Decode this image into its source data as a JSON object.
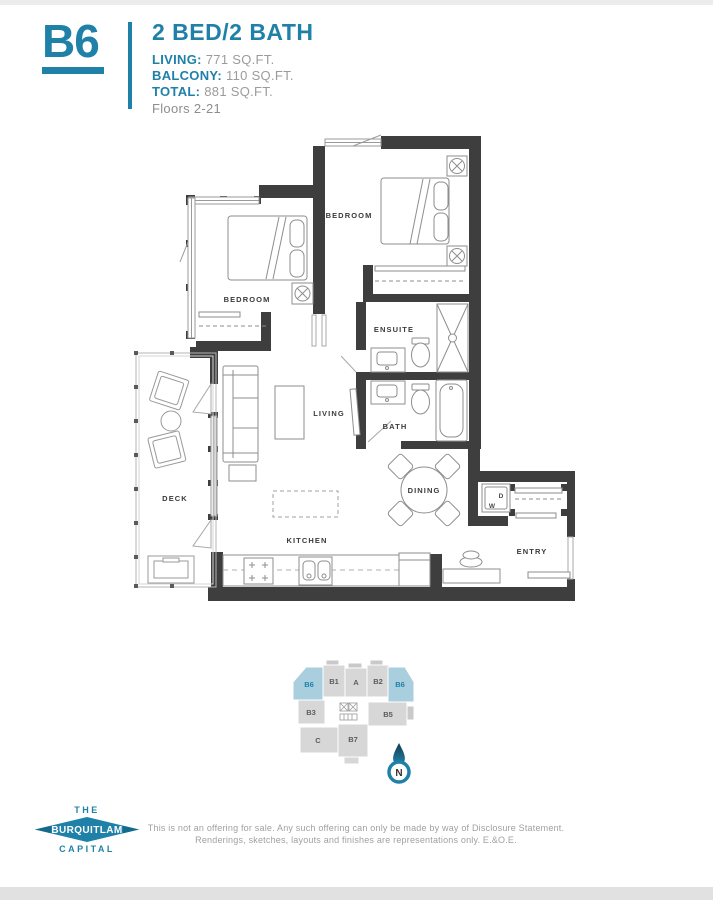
{
  "header": {
    "unit_code": "B6",
    "unit_type": "2 BED/2 BATH",
    "stats": [
      {
        "label": "LIVING:",
        "value": "771 SQ.FT."
      },
      {
        "label": "BALCONY:",
        "value": "110 SQ.FT."
      },
      {
        "label": "TOTAL:",
        "value": "881 SQ.FT."
      }
    ],
    "floors": "Floors 2-21"
  },
  "floorplan": {
    "labels": {
      "bedroom_left": "BEDROOM",
      "bedroom_right": "BEDROOM",
      "ensuite": "ENSUITE",
      "bath": "BATH",
      "living": "LIVING",
      "deck": "DECK",
      "dining": "DINING",
      "kitchen": "KITCHEN",
      "entry": "ENTRY",
      "dryer": "D",
      "washer": "W"
    }
  },
  "keyplan": {
    "units": [
      {
        "label": "B6",
        "highlighted": true
      },
      {
        "label": "B1",
        "highlighted": false
      },
      {
        "label": "A",
        "highlighted": false
      },
      {
        "label": "B2",
        "highlighted": false
      },
      {
        "label": "B6",
        "highlighted": true
      },
      {
        "label": "B3",
        "highlighted": false
      },
      {
        "label": "B5",
        "highlighted": false
      },
      {
        "label": "C",
        "highlighted": false
      },
      {
        "label": "B7",
        "highlighted": false
      }
    ],
    "north_label": "N"
  },
  "logo": {
    "top": "THE",
    "middle": "BURQUITLAM",
    "bottom": "CAPITAL"
  },
  "disclaimer": {
    "line1": "This is not an offering for sale. Any such offering can only be made by way of Disclosure Statement.",
    "line2": "Renderings, sketches, layouts and finishes are representations only. E.&O.E."
  },
  "colors": {
    "accent": "#1f81a8",
    "wall": "#3e3e3e",
    "keyplan_highlight": "#a9cede",
    "keyplan_gray": "#d7d7d7"
  }
}
